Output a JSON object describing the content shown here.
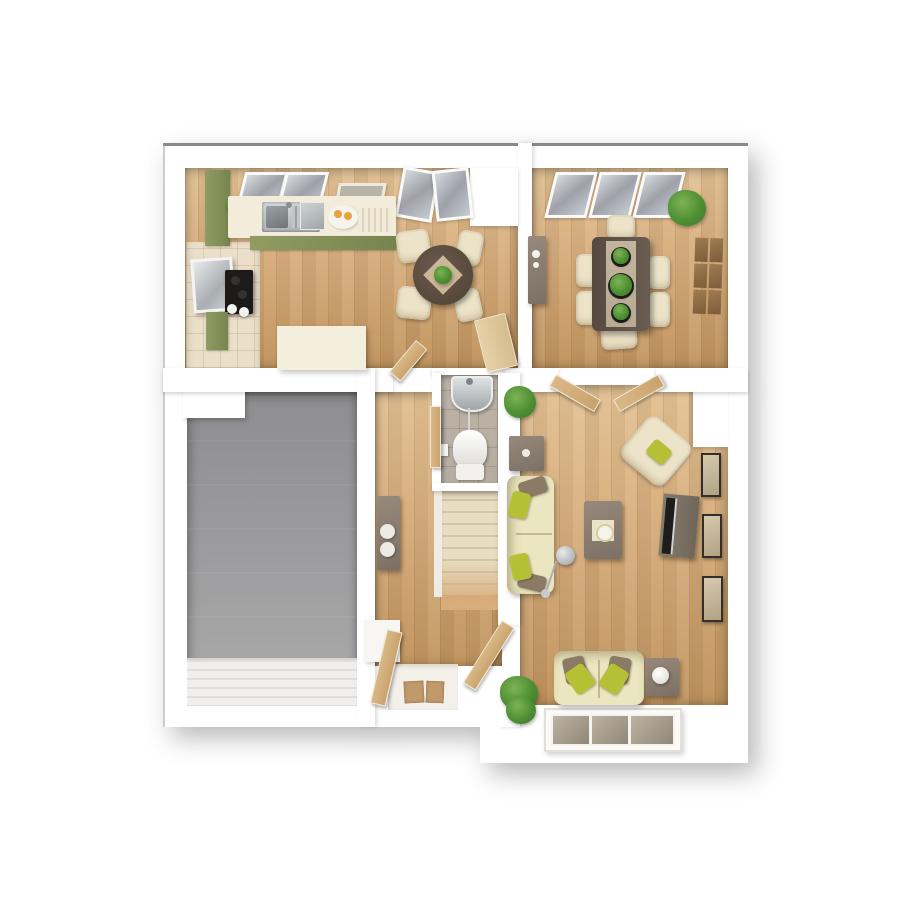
{
  "scene": {
    "type": "3d-rendered-floor-plan",
    "view": "top-down",
    "background": "white"
  },
  "palette": {
    "page_bg": "#ffffff",
    "wall": "#ffffff",
    "wall_edge_dark": "#4a4a4a",
    "wood": "#d7ad7c",
    "wood_dark": "#c1945e",
    "wood_light": "#e3c294",
    "kitchen_tile": "#ebdfc9",
    "garage_floor": "#9b9b9d",
    "garage_floor_dark": "#8e8e90",
    "wc_tile": "#b6ada1",
    "wc_grout": "#a49b8f",
    "stairs_carpet": "#e8ddc2",
    "stairs_step_shadow": "#d3c5a5",
    "cabinet_green": "#909c62",
    "cabinet_green_dark": "#77844e",
    "worktop": "#f3ecdb",
    "cream_unit": "#f4eedd",
    "table_wood": "#5f5349",
    "table_stone": "#b9aa94",
    "chair_cream": "#ece3c9",
    "chair_shadow": "#d6c9a9",
    "sofa_cream": "#eae6bf",
    "pillow_green": "#b4c135",
    "pillow_brown": "#8b7a66",
    "plant_green": "#58a140",
    "plant_dark": "#3e7d2c",
    "door_wood": "#d9b888",
    "door_wood_pale": "#e6d2a8",
    "glass_light": "#d4dbdd",
    "glass_dark": "#9fa0a8",
    "frame_dark": "#332e29",
    "frame_beige": "#d6c9ae",
    "furn_gray_brown": "#8d8176",
    "tv_dark": "#1f1d1b",
    "metal": "#b9bcbe",
    "mat_brown": "#c19a6b"
  },
  "rooms": [
    {
      "id": "kitchen-breakfast",
      "floor": "wood-plank",
      "items": [
        "green-kitchen-units",
        "worktop",
        "sink",
        "hob",
        "oven",
        "counter-plants",
        "juice-tray",
        "cream-island",
        "round-breakfast-table",
        "four-cream-chairs",
        "window",
        "wall-art",
        "french-doors"
      ]
    },
    {
      "id": "dining-room",
      "floor": "wood-plank",
      "items": [
        "dining-table",
        "six-cream-chairs",
        "three-table-plants",
        "sideboard",
        "corner-plant",
        "wood-wall-panels",
        "windows"
      ]
    },
    {
      "id": "garage",
      "floor": "concrete-gray",
      "items": [
        "garage-door"
      ]
    },
    {
      "id": "hallway",
      "floor": "wood-plank",
      "items": [
        "console-table",
        "two-stools",
        "white-bench",
        "front-door",
        "doormats"
      ]
    },
    {
      "id": "wc",
      "floor": "gray-tile",
      "items": [
        "wash-basin",
        "toilet",
        "roll-holder"
      ]
    },
    {
      "id": "stairs",
      "floor": "beige-carpet",
      "items": [
        "steps"
      ]
    },
    {
      "id": "living-room",
      "floor": "wood-plank",
      "items": [
        "three-seat-sofa",
        "two-seat-sofa",
        "armchair",
        "coffee-table",
        "square-side-table",
        "lamp-side-table",
        "tv-unit",
        "arc-floor-lamp",
        "three-wall-frames",
        "corner-plants",
        "double-doors",
        "window"
      ]
    }
  ]
}
